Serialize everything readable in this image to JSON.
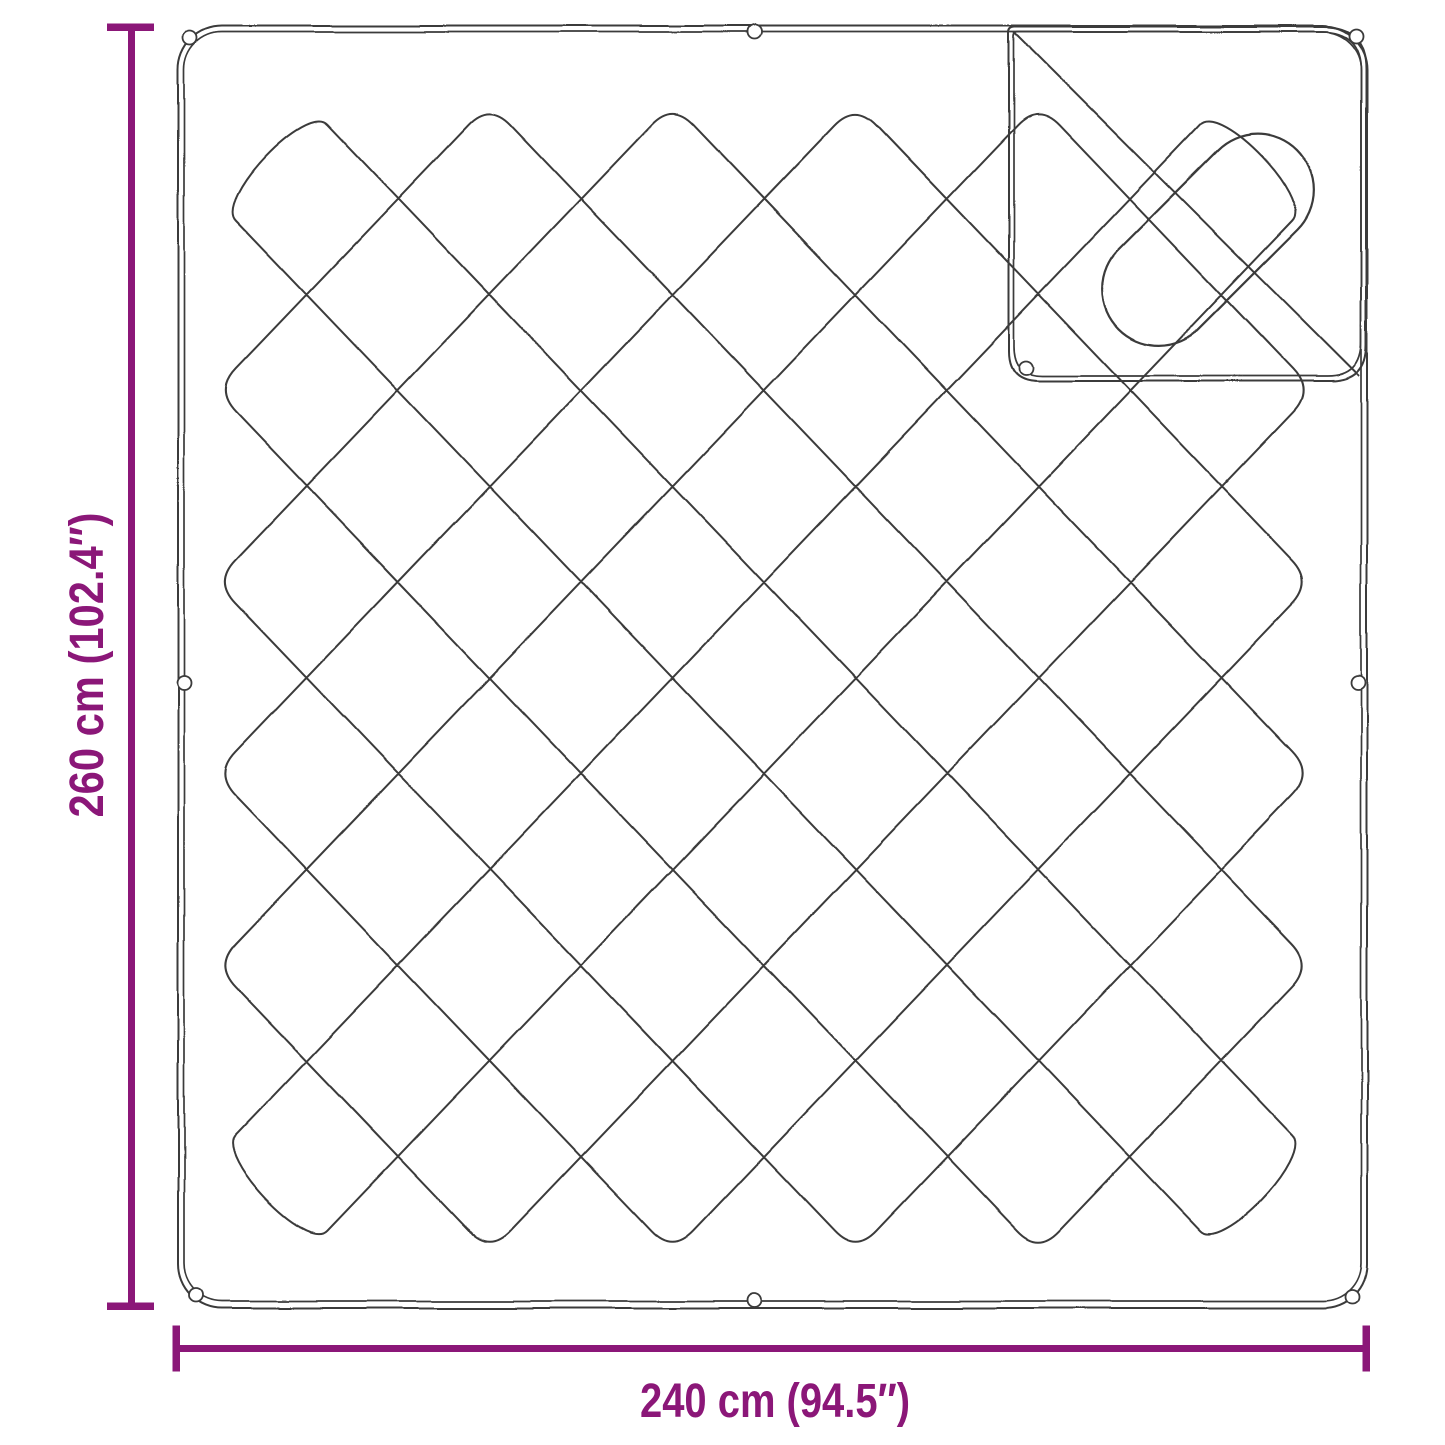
{
  "diagram": {
    "height_dimension": {
      "label": "260 cm (102.4″)"
    },
    "width_dimension": {
      "label": "240 cm (94.5″)"
    },
    "colors": {
      "accent": "#8B1778",
      "line": "#3A3A3A",
      "background": "#FFFFFF"
    }
  }
}
